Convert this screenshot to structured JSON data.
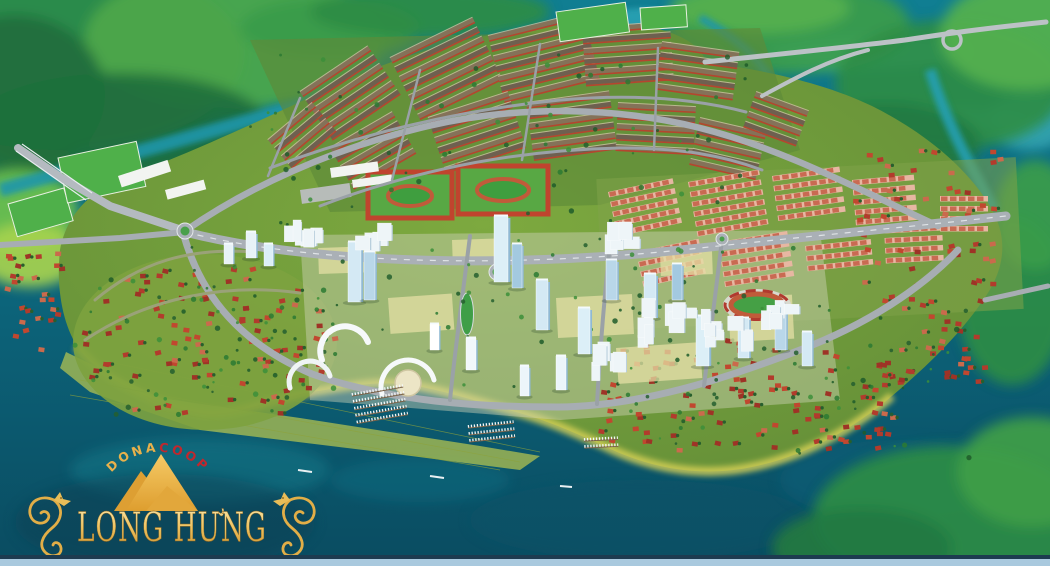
{
  "brand": {
    "arc_left": "DONA",
    "arc_right": "COOP",
    "project_name": "LONG HƯNG"
  },
  "icons": {
    "mountain": "mountain-icon",
    "dragon_left": "dragon-left-icon",
    "dragon_right": "dragon-right-icon"
  },
  "colors": {
    "gold": "#E8B14B",
    "gold_light": "#F9E7AC",
    "gold_deep": "#C78F2C",
    "brand_red": "#C1272D",
    "water": "#0E7389",
    "water_deep": "#0A5064",
    "water_bright": "#2FA8B8",
    "marsh_green": "#2E9447",
    "marsh_bright": "#6CC24C",
    "island_green": "#6B9C3E",
    "shore_band": "#D6D056",
    "villa_roof": "#B23B2C",
    "villa_palette": [
      "#B23B2C",
      "#C1472F",
      "#9E3326",
      "#CA6A4C"
    ],
    "rowhouse_body": "#E7B7A2",
    "rowhouse_roof": "#C96A52",
    "townhouse_dark": "#6E6050",
    "townhouse_light": "#847259",
    "townhouse_red": "#B5452F",
    "tower_face": "#DCEFF7",
    "tower_side": "#8FB9D4",
    "road": "#A7ADB3",
    "track_terracotta": "#C05B3A",
    "pitch_green": "#4FB04A",
    "tree_palette": [
      "#1E5C2A",
      "#2C7A33",
      "#3C8F3A",
      "#245F2F"
    ],
    "footer_navy": "#1D3B50",
    "footer_strip": "#A9C9DE"
  }
}
